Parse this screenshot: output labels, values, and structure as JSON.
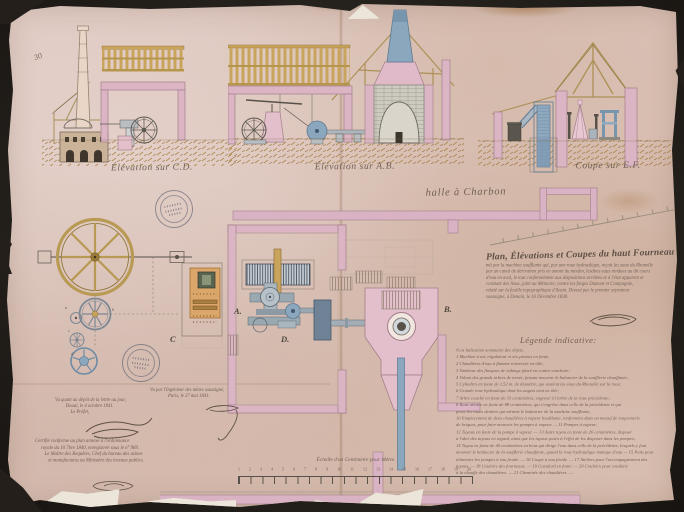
{
  "captions": {
    "elevation_cd": "Élévation sur C.D.",
    "elevation_ab": "Élévation sur A.B.",
    "coupe_ef": "Coupe sur E.F.",
    "halle": "halle à Charbon",
    "corner_mark": "30"
  },
  "title_block": {
    "title": "Plan, Élévations et Coupes du haut Fourneau",
    "lines": [
      "mû par la machine soufflante qui, par une roue hydraulique, reçoit les eaux du Rhonelle",
      "par un canal de dérivation pris en amont du moulin, lesdites eaux rendues au dit cours",
      "d'eau en aval, le tout conformément aux dispositions arrêtées et à l'état apparent et",
      "constaté des lieux, joint au Mémoire, contre les forges Dumont et Compagnie,",
      "relaté sur la feuille topographique d'Anzin. Dressé par le premier arpenteur",
      "soussigné, à Denain, le 16 Décembre 1838."
    ]
  },
  "legend": {
    "heading": "Légende indicative:",
    "items": [
      "N.os   Indication sommaire des objets.",
      "1  Machine à air, régulateur et ses pistons en fonte;",
      "2  Chaudières d'eau à flamme renversée en tôle;",
      "3  Tambour des flasques de vidange placé en contre-courbure;",
      "4  Volant des grands arbres de trente, faisant mouvoir le balancier de la soufflerie chauffante;",
      "5  Cylindres en fonte de 1,52 m. de diamètre, qui avalent les eaux du Rhonelle sur la roue;",
      "6  Grande roue hydraulique dont les augets sont en tôle;",
      "7  Arbre couché en fonte de 33 centimètres, engrené à l'arbre de la roue précédente;",
      "8  Roue dentée en fonte de 88 centimètres, qui s'engrène dans celle de la précédente et qui",
      "porte les roues dentées qui mènent le balancier de la machine soufflante;",
      "10  Emplacement de deux chaudières à vapeur bouillante, renfermées dans un massif de maçonnerie",
      "de briques, pour faire mouvoir les pompes à vapeur. — 11  Pompes à vapeur;",
      "12  Tuyaux en fonte de la pompe à vapeur. — 13  Autre tuyau en fonte de 26 centimètres, disposé",
      "à l'abri des tuyaux en regard, ainsi que les tuyaux posés à l'effet de les disposer dans les pompes;",
      "14  Tuyau en fonte de 40 centimètres en bout qui dirige l'eau dans celle de la précédente, lesquels y font",
      "mouvoir le balancier de la soufflerie chauffante, quand la roue hydraulique manque d'eau — 15  Puits pour",
      "alimenter les pompes à eau froide. — 16  Coupe à eau froide. — 17  Ateliers pour l'accompagnement des",
      "tuyaux. — 18  Couloirs des fourneaux. — 19  Gueulard en fonte. — 20  Couloirs pour conduire",
      "à la chauffe des chaudières. — 21  Cheminée des chaudières. —"
    ]
  },
  "annotations": {
    "engineer": [
      "Vu par l'Ingénieur des mines soussigné,",
      "Paris, le 27 mai 1841."
    ],
    "prefect": [
      "Vu quant au dépôt de la lettre au jour,",
      "Douai, le 4 octobre 1841.",
      "Le Préfet,"
    ],
    "certification": [
      "Certifié conforme au plan annexé à l'ordonnance",
      "royale du 10 7bre 1840, enregistrée sous le n° 989.",
      "Le Maître des Requêtes, Chef du bureau des usines",
      "et manufactures au Ministère des travaux publics."
    ]
  },
  "scale": {
    "caption": "Échelle d'un Centimètre pour Mètre.",
    "ticks": "1 2 3 4 5 6 7 8 9 10 11 12 13 14 15 16 17 18 19 20"
  },
  "plan_labels": {
    "a": "A.",
    "b": "B.",
    "c": "C",
    "d": "D."
  },
  "palette": {
    "wall_pink": "#dcb5c4",
    "machine_blue": "#8ba7bd",
    "wood_tan": "#c9a45c",
    "ink": "#6e6156",
    "paper": "#dcc5bc"
  }
}
